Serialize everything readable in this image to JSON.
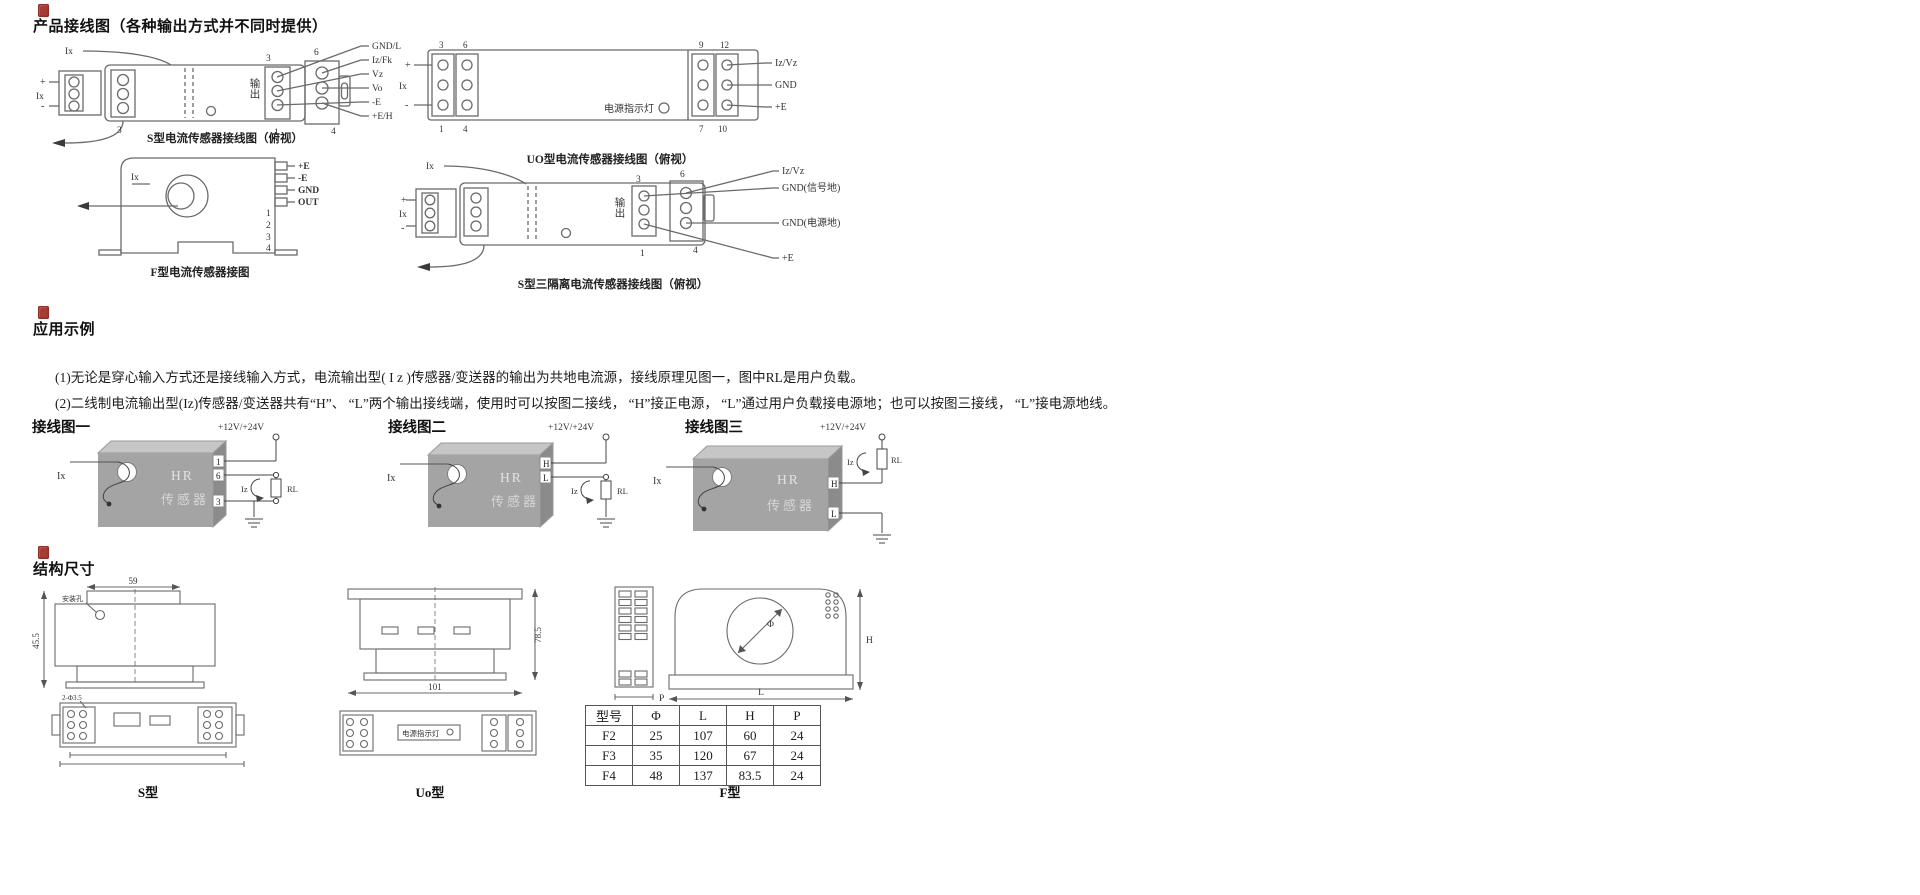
{
  "colors": {
    "accent_red": "#a63c36",
    "diagram_line": "#666666",
    "module_gray": "#a8a8a8"
  },
  "sections": {
    "wiring": {
      "title": "产品接线图（各种输出方式并不同时提供）",
      "s_type": {
        "caption": "S型电流传感器接线图（俯视）",
        "input_top": "Ix",
        "plus": "+",
        "input_side": "Ix",
        "minus": "-",
        "left_num": "3",
        "output_label": "输出",
        "terminals": [
          "3",
          "6",
          "1",
          "4"
        ],
        "pins": [
          "GND/L",
          "Iz/Fk",
          "Vz",
          "Vo",
          "-E",
          "+E/H"
        ]
      },
      "f_type": {
        "caption": "F型电流传感器接图",
        "input": "Ix",
        "pins": [
          "+E",
          "-E",
          "GND",
          "OUT"
        ],
        "terminals": [
          "1",
          "2",
          "3",
          "4"
        ]
      },
      "uo_type": {
        "caption": "UO型电流传感器接线图（俯视）",
        "input": "Ix",
        "plus": "+",
        "minus": "-",
        "indicator": "电源指示灯",
        "left_terminals": [
          "3",
          "6",
          "1",
          "4"
        ],
        "right_terminals": [
          "9",
          "12",
          "7",
          "10"
        ],
        "pins": [
          "Iz/Vz",
          "GND",
          "+E"
        ]
      },
      "s3_type": {
        "caption": "S型三隔离电流传感器接线图（俯视）",
        "input_top": "Ix",
        "plus": "+",
        "input_side": "Ix",
        "minus": "-",
        "output_label": "输出",
        "terminals": [
          "3",
          "6",
          "1",
          "4"
        ],
        "pins": [
          "Iz/Vz",
          "GND(信号地)",
          "GND(电源地)",
          "+E"
        ]
      }
    },
    "application": {
      "title": "应用示例",
      "para1": "(1)无论是穿心输入方式还是接线输入方式，电流输出型( I z )传感器/变送器的输出为共地电流源，接线原理见图一，图中RL是用户负载。",
      "para2": "(2)二线制电流输出型(Iz)传感器/变送器共有“H”、 “L”两个输出接线端，使用时可以按图二接线， “H”接正电源， “L”通过用户负载接电源地；也可以按图三接线， “L”接电源地线。",
      "figs": [
        {
          "label": "接线图一",
          "input": "Ix",
          "supply": "+12V/+24V",
          "box_line1": "HR",
          "box_line2": "传感器",
          "iz": "Iz",
          "rl": "RL",
          "terminals": [
            "1",
            "6",
            "3"
          ]
        },
        {
          "label": "接线图二",
          "input": "Ix",
          "supply": "+12V/+24V",
          "box_line1": "HR",
          "box_line2": "传感器",
          "iz": "Iz",
          "rl": "RL",
          "terminals": [
            "H",
            "L"
          ]
        },
        {
          "label": "接线图三",
          "input": "Ix",
          "supply": "+12V/+24V",
          "box_line1": "HR",
          "box_line2": "传感器",
          "iz": "Iz",
          "rl": "RL",
          "terminals": [
            "H",
            "L"
          ]
        }
      ]
    },
    "dimensions": {
      "title": "结构尺寸",
      "s": {
        "caption": "S型",
        "dim_width": "59",
        "dim_height": "45.5",
        "hole_label": "安装孔",
        "holes_label": "2-Φ3.5"
      },
      "uo": {
        "caption": "Uo型",
        "dim_height": "78.5",
        "dim_bottom": "101",
        "indicator": "电源指示灯"
      },
      "f": {
        "caption": "F型",
        "dim_phi": "Φ",
        "dim_h": "H",
        "dim_l": "L",
        "dim_p": "P"
      },
      "table": {
        "headers": [
          "型号",
          "Φ",
          "L",
          "H",
          "P"
        ],
        "rows": [
          [
            "F2",
            "25",
            "107",
            "60",
            "24"
          ],
          [
            "F3",
            "35",
            "120",
            "67",
            "24"
          ],
          [
            "F4",
            "48",
            "137",
            "83.5",
            "24"
          ]
        ]
      }
    }
  }
}
